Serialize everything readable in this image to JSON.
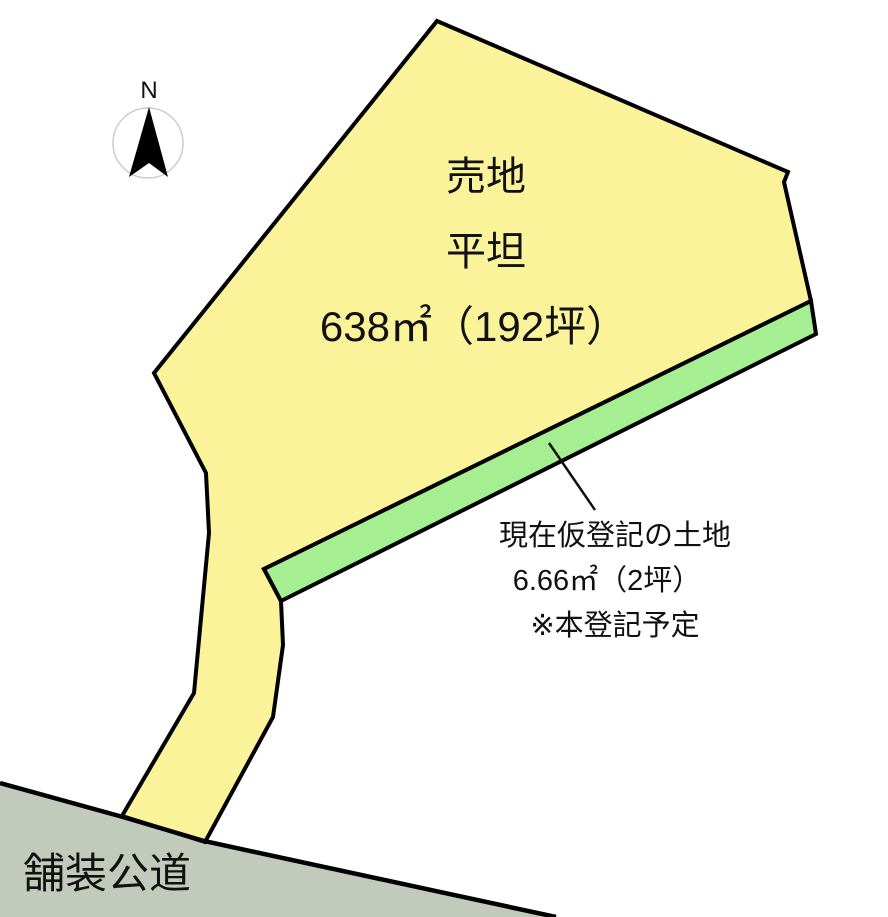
{
  "diagram": {
    "compass": {
      "label": "N"
    },
    "plot": {
      "status": "売地",
      "terrain": "平坦",
      "area": "638㎡（192坪）"
    },
    "annotation": {
      "line1": "現在仮登記の土地",
      "line2": "6.66㎡（2坪）",
      "line3": "※本登記予定"
    },
    "road": {
      "label": "舗装公道"
    }
  },
  "colors": {
    "plot_fill": "#FBF399",
    "strip_fill": "#A6EE92",
    "road_fill": "#C2CABC",
    "outline": "#000000",
    "text": "#111111",
    "compass_arrow": "#000000"
  }
}
